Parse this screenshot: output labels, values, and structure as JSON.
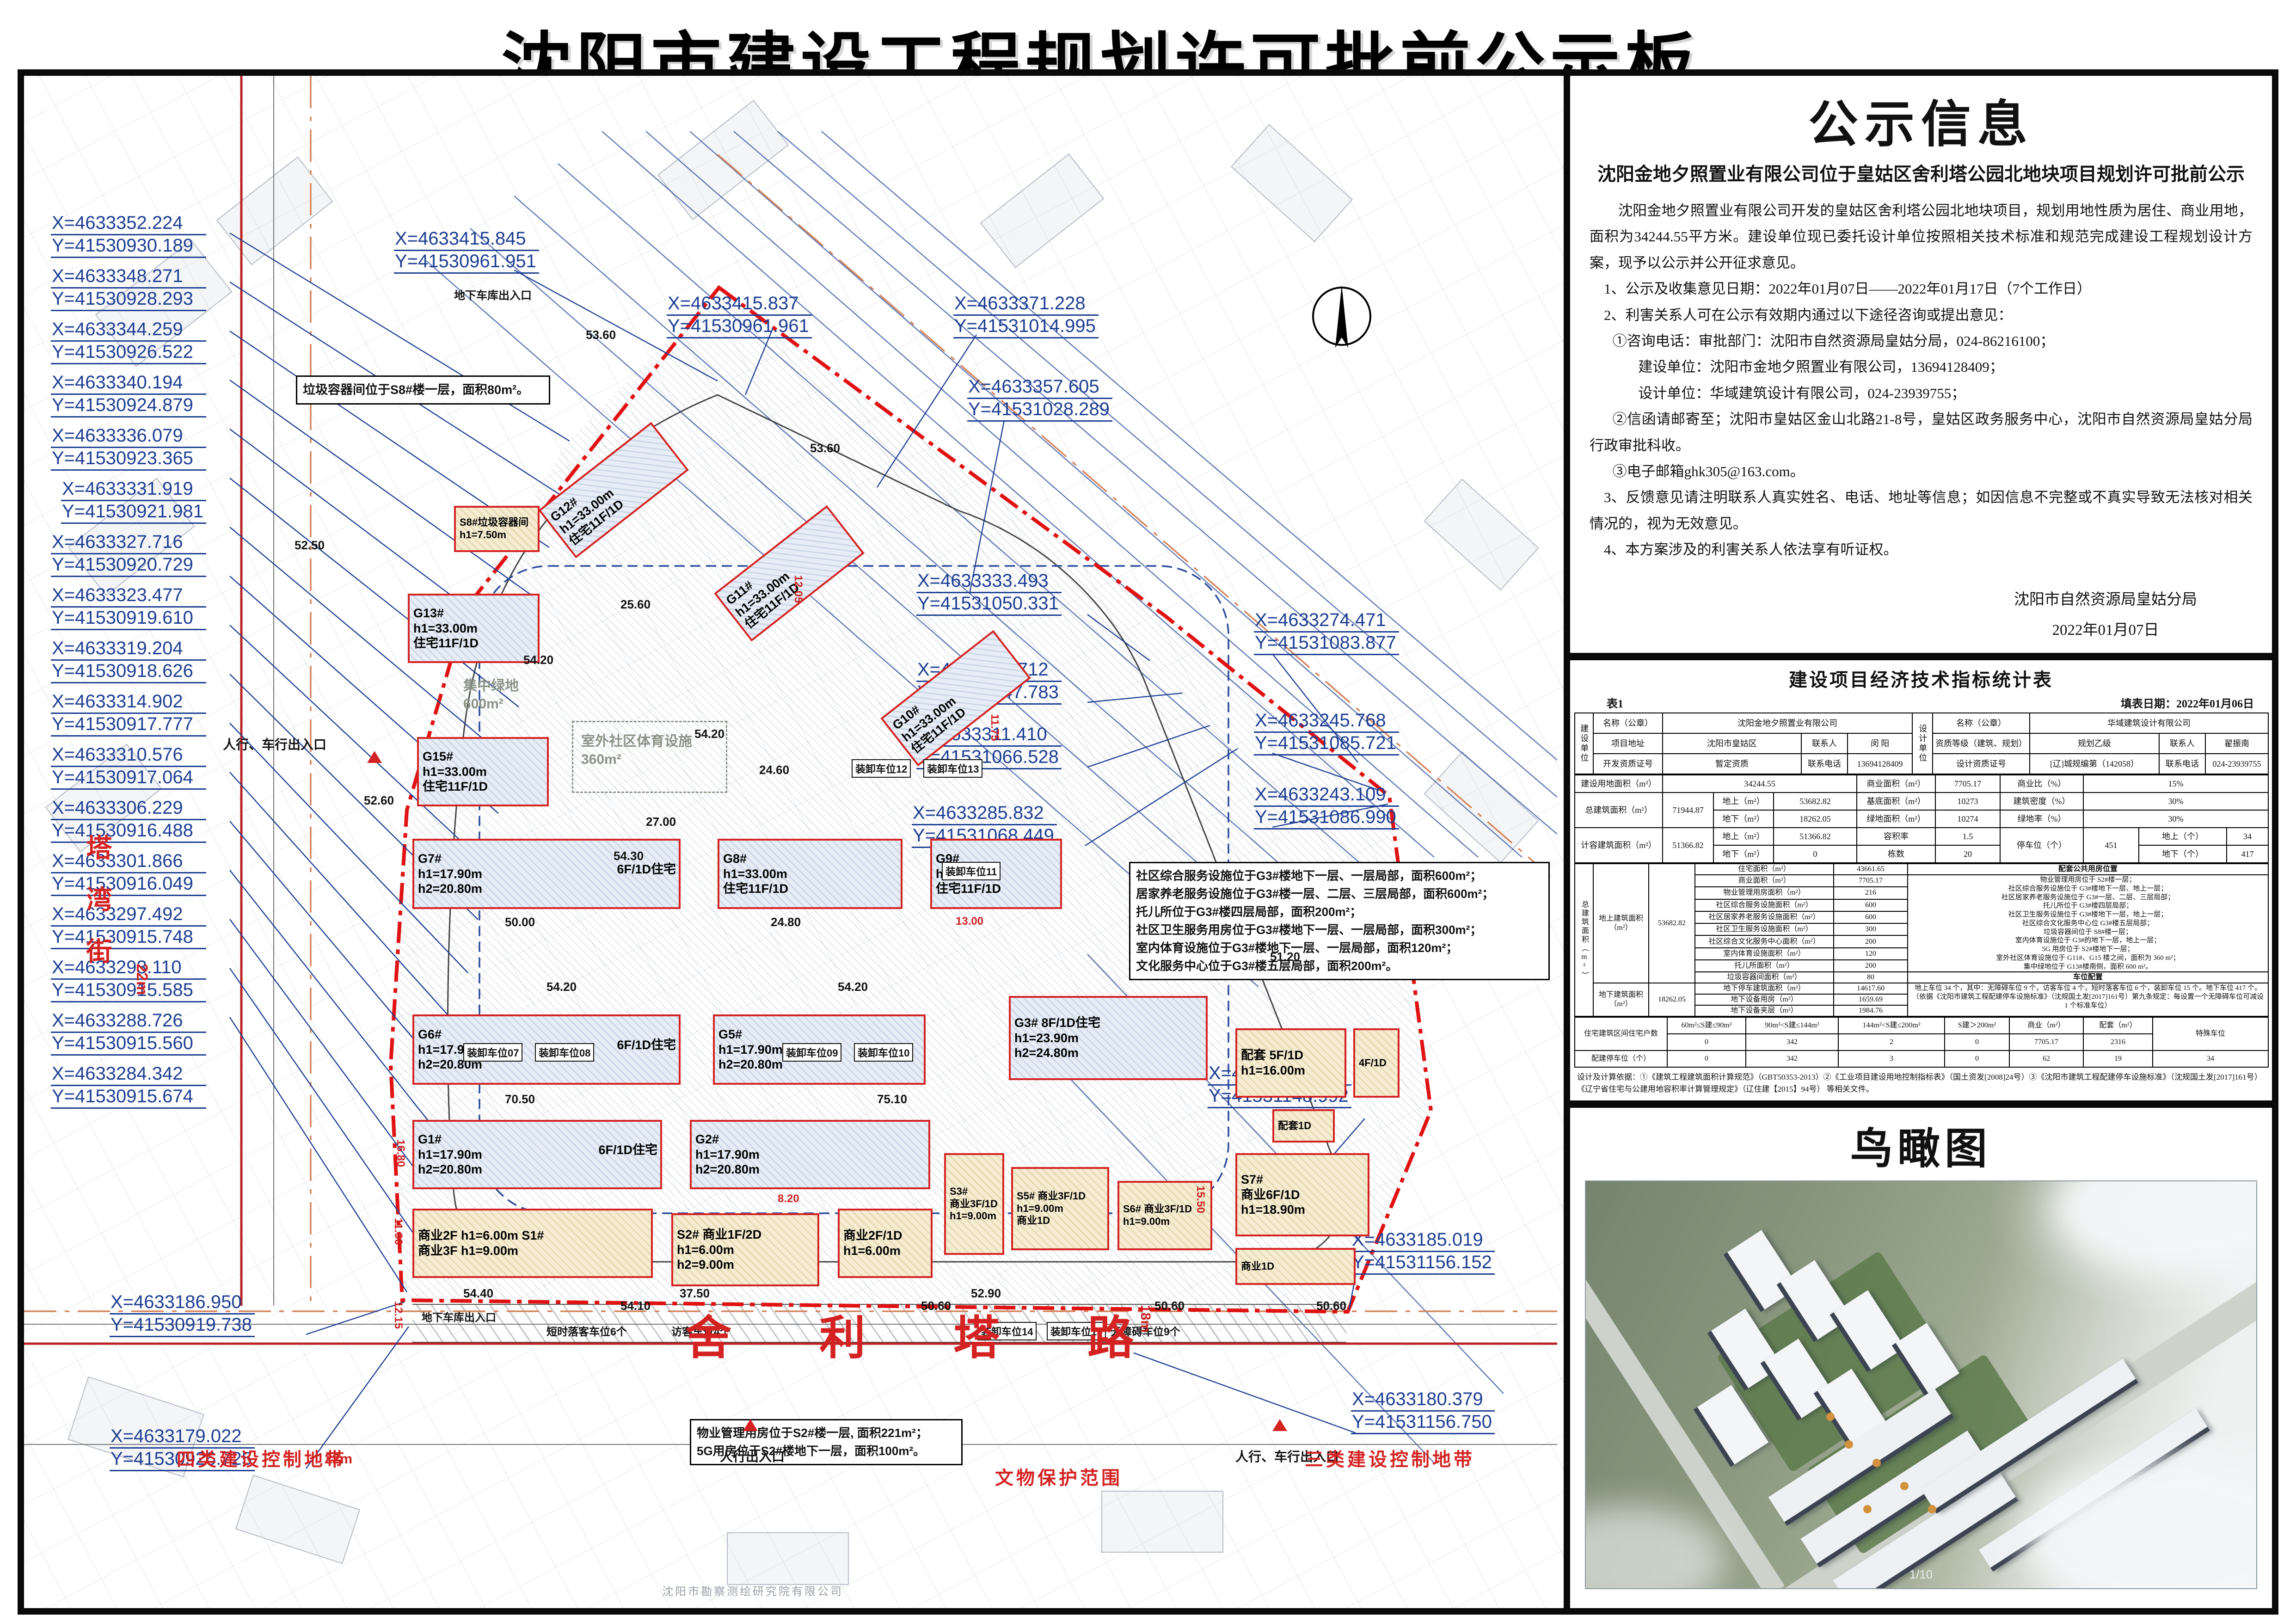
{
  "title": "沈阳市建设工程规划许可批前公示板",
  "notice": {
    "heading": "公示信息",
    "sub": "沈阳金地夕照置业有限公司位于皇姑区舍利塔公园北地块项目规划许可批前公示",
    "p": [
      "沈阳金地夕照置业有限公司开发的皇姑区舍利塔公园北地块项目，规划用地性质为居住、商业用地，面积为34244.55平方米。建设单位现已委托设计单位按照相关技术标准和规范完成建设工程规划设计方案，现予以公示并公开征求意见。",
      "1、公示及收集意见日期：2022年01月07日——2022年01月17日（7个工作日）",
      "2、利害关系人可在公示有效期内通过以下途径咨询或提出意见：",
      "①咨询电话：审批部门：沈阳市自然资源局皇姑分局，024-86216100；",
      "建设单位：沈阳市金地夕照置业有限公司，13694128409；",
      "设计单位：华域建筑设计有限公司，024-23939755；",
      "②信函请邮寄至；沈阳市皇姑区金山北路21-8号，皇姑区政务服务中心，沈阳市自然资源局皇姑分局行政审批科收。",
      "③电子邮箱ghk305@163.com。",
      "3、反馈意见请注明联系人真实姓名、电话、地址等信息；如因信息不完整或不真实导致无法核对相关情况的，视为无效意见。",
      "4、本方案涉及的利害关系人依法享有听证权。"
    ],
    "sig1": "沈阳市自然资源局皇姑分局",
    "sig2": "2022年01月07日"
  },
  "table": {
    "title": "建设项目经济技术指标统计表",
    "no": "表1",
    "date": "填表日期：2022年01月06日",
    "t1": {
      "b_unit": "建设单位",
      "d_unit": "设计单位",
      "name_l": "名称（公章）",
      "b_name": "沈阳金地夕照置业有限公司",
      "name_l2": "名称（公章）",
      "d_name": "华域建筑设计有限公司",
      "addr_l": "项目地址",
      "addr": "沈阳市皇姑区",
      "contact_l": "联系人",
      "b_contact": "闵 阳",
      "grade_l": "资质等级（建筑、规划）",
      "grade": "规划乙级",
      "contact_l2": "联系人",
      "d_contact": "翟振南",
      "devc_l": "开发资质证号",
      "devc": "暂定资质",
      "phone_l": "联系电话",
      "b_phone": "13694128409",
      "desc_l": "设计资质证号",
      "desc": "[辽]城规编第（142058）",
      "phone_l2": "联系电话",
      "d_phone": "024-23939755"
    },
    "t2": {
      "land_l": "建设用地面积（m²）",
      "land": "34244.55",
      "comm_l": "商业面积（m²）",
      "comm": "7705.17",
      "commr_l": "商业比（%）",
      "commr": "15%",
      "tot_l": "总建筑面积（m²）",
      "tot": "71944.87",
      "up_l": "地上（m²）",
      "tot_up": "53682.82",
      "base_l": "基底面积（m²）",
      "base": "10273",
      "dens_l": "建筑密度（%）",
      "dens": "30%",
      "dn_l": "地下（m²）",
      "tot_dn": "18262.05",
      "green_l": "绿地面积（m²）",
      "green": "10274",
      "greenr_l": "绿地率（%）",
      "greenr": "30%",
      "cap_l": "计容建筑面积（m²）",
      "cap": "51366.82",
      "up_l2": "地上（m²）",
      "cap_up": "51366.82",
      "far_l": "容积率",
      "far": "1.5",
      "park_l": "停车位（个）",
      "park": "451",
      "pup_l": "地上（个）",
      "pup": "34",
      "dn_l2": "地下（m²）",
      "cap_dn": "0",
      "cnt_l": "栋数",
      "cnt": "20",
      "pdn_l": "地下（个）",
      "pdn": "417"
    },
    "t3": {
      "big_l": "总建筑面积（m²）",
      "up_sec_l": "地上建筑面积（m²）",
      "up_sec_v": "53682.82",
      "above": [
        {
          "l": "住宅面积（m²）",
          "v": "43661.65"
        },
        {
          "l": "商业面积（m²）",
          "v": "7705.17"
        },
        {
          "l": "物业管理用房面积（m²）",
          "v": "216"
        },
        {
          "l": "社区综合服务设施面积（m²）",
          "v": "600"
        },
        {
          "l": "社区居家养老服务设施面积（m²）",
          "v": "600"
        },
        {
          "l": "社区卫生服务设施面积（m²）",
          "v": "300"
        },
        {
          "l": "社区综合文化服务中心面积（m²）",
          "v": "200"
        },
        {
          "l": "室内体育设施面积（m²）",
          "v": "120"
        },
        {
          "l": "托儿所面积（m²）",
          "v": "200"
        },
        {
          "l": "垃圾容器间面积（m²）",
          "v": "80"
        }
      ],
      "loc_h": "配套公共用房位置",
      "loc_lines": [
        "物业管理用房位于 S2#楼一层；",
        "社区综合服务设施位于 G3#楼地下一层、地上一层；",
        "社区居家养老服务设施位于 G3#一层、二层、三层局部；",
        "托儿所位于 G3#楼四层局部；",
        "社区卫生服务设施位于 G3#楼地下一层，地上一层；",
        "社区综合文化服务中心位 G3#楼五层局部；",
        "垃圾容器间位于 S8#楼一层；",
        "室内体育设施位于 G3#的地下一层，地上一层；",
        "5G 用房位于 S2#楼地下一层；",
        "室外社区体育设施位于 G11#、G15 楼之间，面积为 360 m²；",
        "集中绿地位于 G13#楼南侧，面积 600 m²。"
      ],
      "cfg_h": "车位配置",
      "dn_sec_l": "地下建筑面积（m²）",
      "dn_sec_v": "18262.05",
      "below": [
        {
          "l": "地下停车建筑面积（m²）",
          "v": "14617.60"
        },
        {
          "l": "地下设备用房（m²）",
          "v": "1659.69"
        },
        {
          "l": "地下设备夹层（m²）",
          "v": "1984.76"
        }
      ],
      "park_lines": [
        "地上车位 34 个，其中：无障碍车位 9 个，访客车位 4 个，短时落客车位 6 个，装卸车位 15 个。地下车位 417 个。",
        "（依据《沈阳市建筑工程配建停车设施标准》（沈规国土发[2017]161号）第九条规定：每设置一个无障碍车位可减设 1 个标准车位）"
      ]
    },
    "t4": {
      "hh_l": "住宅建筑区间住宅户数",
      "ranges": [
        "60m²≤S建≤90m²",
        "90m²<S建≤144m²",
        "144m²<S建≤200m²",
        "S建＞200m²",
        "商业（m²）",
        "配套（m²）"
      ],
      "special": "特殊车位",
      "hh_vals": [
        "0",
        "342",
        "2",
        "0",
        "7705.17",
        "2316"
      ],
      "pk_l": "配建停车位（个）",
      "pk_vals": [
        "0",
        "342",
        "3",
        "0",
        "62",
        "19",
        "34"
      ]
    },
    "foot": [
      "设计及计算依据：①《建筑工程建筑面积计算规范》（GBT50353-2013）②《工业项目建设用地控制指标表》（国土资发[2008]24号）③《沈阳市建筑工程配建停车设施标准》（沈规国土发[2017]161号）",
      "《辽宁省住宅与公建用地容积率计算管理规定》（辽住建【2015】94号）  等相关文件。"
    ]
  },
  "birdseye": {
    "heading": "鸟瞰图",
    "watermark": "1/10"
  },
  "plan": {
    "coords_left": [
      {
        "x": "X=4633352.224",
        "y": "Y=41530930.189"
      },
      {
        "x": "X=4633348.271",
        "y": "Y=41530928.293"
      },
      {
        "x": "X=4633344.259",
        "y": "Y=41530926.522"
      },
      {
        "x": "X=4633340.194",
        "y": "Y=41530924.879"
      },
      {
        "x": "X=4633336.079",
        "y": "Y=41530923.365"
      },
      {
        "x": "X=4633331.919",
        "y": "Y=41530921.981"
      },
      {
        "x": "X=4633327.716",
        "y": "Y=41530920.729"
      },
      {
        "x": "X=4633323.477",
        "y": "Y=41530919.610"
      },
      {
        "x": "X=4633319.204",
        "y": "Y=41530918.626"
      },
      {
        "x": "X=4633314.902",
        "y": "Y=41530917.777"
      },
      {
        "x": "X=4633310.576",
        "y": "Y=41530917.064"
      },
      {
        "x": "X=4633306.229",
        "y": "Y=41530916.488"
      },
      {
        "x": "X=4633301.866",
        "y": "Y=41530916.049"
      },
      {
        "x": "X=4633297.492",
        "y": "Y=41530915.748"
      },
      {
        "x": "X=4633293.110",
        "y": "Y=41530915.585"
      },
      {
        "x": "X=4633288.726",
        "y": "Y=41530915.560"
      },
      {
        "x": "X=4633284.342",
        "y": "Y=41530915.674"
      }
    ],
    "coords_top": [
      {
        "x": "X=4633415.845",
        "y": "Y=41530961.951"
      },
      {
        "x": "X=4633415.837",
        "y": "Y=41530961.961"
      },
      {
        "x": "X=4633371.228",
        "y": "Y=41531014.995"
      },
      {
        "x": "X=4633357.605",
        "y": "Y=41531028.289"
      }
    ],
    "coords_right": [
      {
        "x": "X=4633333.493",
        "y": "Y=41531050.331"
      },
      {
        "x": "X=4633327.712",
        "y": "Y=41531047.783"
      },
      {
        "x": "X=4633311.410",
        "y": "Y=41531066.528"
      },
      {
        "x": "X=4633285.832",
        "y": "Y=41531068.449"
      },
      {
        "x": "X=4633274.471",
        "y": "Y=41531083.877"
      },
      {
        "x": "X=4633245.768",
        "y": "Y=41531085.721"
      },
      {
        "x": "X=4633243.109",
        "y": "Y=41531086.990"
      },
      {
        "x": "X=4633240.524",
        "y": "Y=41531148.992"
      },
      {
        "x": "X=4633185.019",
        "y": "Y=41531156.152"
      },
      {
        "x": "X=4633180.379",
        "y": "Y=41531156.750"
      }
    ],
    "coords_bottom": [
      {
        "x": "X=4633186.950",
        "y": "Y=41530919.738"
      },
      {
        "x": "X=4633179.022",
        "y": "Y=41530926.725"
      }
    ],
    "buildings": [
      {
        "lines": [
          "G12#",
          "h1=33.00m",
          "住宅11F/1D"
        ]
      },
      {
        "lines": [
          "G11#",
          "h1=33.00m",
          "住宅11F/1D"
        ]
      },
      {
        "lines": [
          "G10#",
          "h1=33.00m",
          "住宅11F/1D"
        ]
      },
      {
        "lines": [
          "G13#",
          "h1=33.00m",
          "住宅11F/1D"
        ]
      },
      {
        "lines": [
          "G15#",
          "h1=33.00m",
          "住宅11F/1D"
        ]
      },
      {
        "lines": [
          "G8#",
          "h1=33.00m",
          "住宅11F/1D"
        ]
      },
      {
        "lines": [
          "G9#",
          "h1=33.00m",
          "住宅11F/1D"
        ]
      },
      {
        "lines": [
          "G7#",
          "h1=17.90m",
          "h2=20.80m",
          "6F/1D住宅"
        ]
      },
      {
        "lines": [
          "G6#",
          "h1=17.90m",
          "h2=20.80m",
          "6F/1D住宅"
        ]
      },
      {
        "lines": [
          "G5#",
          "h1=17.90m",
          "h2=20.80m"
        ]
      },
      {
        "lines": [
          "G1#",
          "h1=17.90m",
          "h2=20.80m",
          "6F/1D住宅"
        ]
      },
      {
        "lines": [
          "G2#",
          "h1=17.90m",
          "h2=20.80m"
        ]
      },
      {
        "lines": [
          "G3#  8F/1D住宅",
          "h1=23.90m",
          "h2=24.80m"
        ]
      },
      {
        "lines": [
          "S8#垃圾容器间",
          "h1=7.50m"
        ]
      },
      {
        "lines": [
          "商业2F h1=6.00m S1#",
          "商业3F h1=9.00m"
        ]
      },
      {
        "lines": [
          "S2# 商业1F/2D",
          "h1=6.00m",
          "h2=9.00m"
        ]
      },
      {
        "lines": [
          "商业2F/1D",
          "h1=6.00m"
        ]
      },
      {
        "lines": [
          "S3#",
          "商业3F/1D",
          "h1=9.00m"
        ]
      },
      {
        "lines": [
          "S5# 商业3F/1D",
          "h1=9.00m",
          "商业1D"
        ]
      },
      {
        "lines": [
          "S6# 商业3F/1D",
          "h1=9.00m"
        ]
      },
      {
        "lines": [
          "S7#",
          "商业6F/1D",
          "h1=18.90m"
        ]
      },
      {
        "lines": [
          "配套 5F/1D",
          "h1=16.00m"
        ]
      },
      {
        "lines": [
          "4F/1D"
        ]
      },
      {
        "lines": [
          "配套1D"
        ]
      },
      {
        "lines": [
          "商业1D"
        ]
      }
    ],
    "notes": {
      "n1": [
        "垃圾容器间位于S8#楼一层，面积80m²。"
      ],
      "n2": [
        "社区综合服务设施位于G3#楼地下一层、一层局部，面积600m²；",
        "居家养老服务设施位于G3#楼一层、二层、三层局部，面积600m²；",
        "托儿所位于G3#楼四层局部，面积200m²；",
        "社区卫生服务用房位于G3#楼地下一层、一层局部，面积300m²；",
        "室内体育设施位于G3#楼地下一层、一层局部，面积120m²；",
        "文化服务中心位于G3#楼五层局部，面积200m²。"
      ],
      "n3": [
        "物业管理用房位于S2#楼一层, 面积221m²；",
        "5G用房位于S2#楼地下一层，面积100m²。"
      ]
    },
    "roads": {
      "west": "塔湾街",
      "south": "舍利塔路"
    },
    "zones": [
      "四类建设控制地带",
      "文物保护范围",
      "三类建设控制地带"
    ],
    "green": [
      {
        "name": "集中绿地",
        "area": "600m²"
      },
      {
        "name": "室外社区体育设施",
        "area": "360m²"
      }
    ],
    "entrances": {
      "e1": "人行、车行出入口",
      "e2": "人行、车行出入口",
      "e3": "人行出入口",
      "e4": "地下车库出入口",
      "e5": "地下车库出入口",
      "e6": "短时落客车位6个",
      "e7": "访客车位4个",
      "e8": "无障碍车位9个"
    },
    "unload": [
      "装卸车位07",
      "装卸车位08",
      "装卸车位09",
      "装卸车位10",
      "装卸车位11",
      "装卸车位12",
      "装卸车位13",
      "装卸车位14",
      "装卸车位15"
    ],
    "spots": [
      "53.60",
      "53.60",
      "52.50",
      "54.20",
      "54.20",
      "54.20",
      "54.20",
      "52.60",
      "54.30",
      "51.20",
      "50.60",
      "50.60",
      "54.10",
      "54.40",
      "37.50",
      "52.90",
      "50.60",
      "25.60",
      "24.60",
      "24.80",
      "50.00",
      "70.50",
      "75.10",
      "27.00"
    ],
    "dims": [
      "22m",
      "18m",
      "12.15",
      "11.90",
      "8.20",
      "12.05",
      "11.75",
      "15.50",
      "13.00",
      "16.80",
      "22m"
    ],
    "surveyor": "沈阳市勘察测绘研究院有限公司"
  }
}
